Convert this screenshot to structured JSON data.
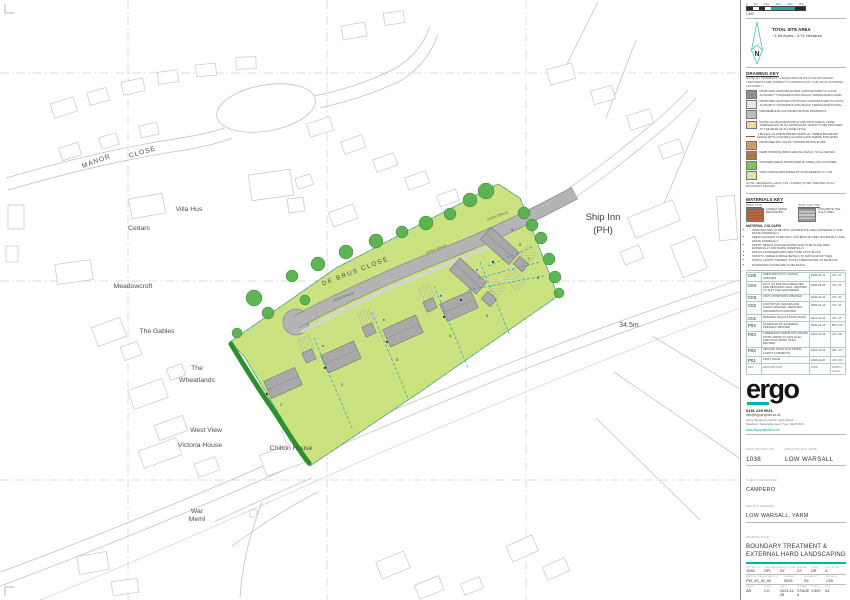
{
  "scale": {
    "ratio_label": "1:500",
    "ticks": [
      "0",
      "5m",
      "10m",
      "15m",
      "20m",
      "25m"
    ]
  },
  "north": {
    "label": "N"
  },
  "site_area": {
    "title": "TOTAL SITE AREA",
    "value": "~1.84 Acres - 0.74 Hectares"
  },
  "drawing_key": {
    "heading": "DRAWING KEY",
    "note": "NOTE: ALL MATERIALS / LANDSCAPE DETAILS AND BOUNDARY TREATMENTS ARE SUBJECT TO APPROVAL BY THE LOCAL PLANNING AUTHORITY",
    "items": [
      {
        "label": "PROPOSED ADOPTED ROADS CONSTRUCTED TO LOCAL AUTHORITY STANDARDS WITH BLACK TARMACADAM FINISH"
      },
      {
        "label": "PROPOSED ADOPTED FOOTPATHS CONSTRUCTED TO LOCAL AUTHORITY STANDARDS WITH BLACK TARMACADAM FINISH"
      },
      {
        "label": "PERMEABLE BLOCK PAVED PRIVATE DRIVEWAYS"
      },
      {
        "label": "PAVING SLAB ACCESS PATHS AND PATIO AREAS. LEVEL THRESHOLDS TO ALL ENTRANCES. PATIOS TO BE PROVIDED TO THE REAR OF ALL DWELLINGS"
      },
      {
        "label": "1.8M HIGH CLOSE BOARDED VERTICAL TIMBER BOUNDARY FENCE WITH LOCKABLE ACCESS GATE WHERE INDICATED"
      },
      {
        "label": "PROPOSED BIG GALAXY 600x600 PAVING SLABS"
      },
      {
        "label": "KERB STANDING BRICK EDGING DETAIL TO ALL DRIVES"
      },
      {
        "label": "GRASSED AREAS MAINTAINED BY DWELLING OCCUPIER"
      },
      {
        "label": "OPEN SPACE MAINTAINED BY MANAGEMENT CO. LTD"
      }
    ],
    "footnote": "NOTE: HEDGEHOG GAPS (130 x 130MM) TO BE CREATED IN ALL BOUNDARY FENCES"
  },
  "materials": {
    "heading": "MATERIALS KEY",
    "brick": {
      "title": "BRICK TYPE",
      "label": "FORMAT MIXED BRICKWORK"
    },
    "roof": {
      "title": "ROOF TILE TYPE",
      "label": "CONCRETE TILE LIGHT GREY"
    },
    "colours_heading": "MATERIAL COLOURS",
    "colours": [
      "WINDOWS ARE TO BE UPVC ANTHRACITE GREY EXTERNALLY AND WHITE INTERNALLY",
      "FRENCH DOORS TO BE UPVC ANTHRACITE GREY EXTERNALLY AND WHITE INTERNALLY",
      "FRONT, REAR & GARAGE DOORS ARE TO BE SLATE GREY EXTERNALLY AND WHITE INTERNALLY",
      "FASCIA & BARGEBOARDS ARE TO BE UPVC BLACK",
      "SOFFITS, VERGE & RIDGE DETAILS TO MATCH ROOF TILES",
      "PORCH CANOPY FRAMES, POSTS & BRICKWORK TO BE BLACK",
      "RAINWATER GOODS ARE TO BE BLACK"
    ]
  },
  "revisions": {
    "headers": {
      "rev": "REV",
      "desc": "DESCRIPTION",
      "date": "DATE",
      "by": "DRWN / CHKD"
    },
    "rows": [
      {
        "rev": "C05",
        "desc": "SHED AND PLOT 1 FENCE UPDATED",
        "date": "2025-02-12",
        "by": "CO / JT"
      },
      {
        "rev": "C04",
        "desc": "PLOT 2/3 RAILINGS REMOVED AND RETAINING WALL UPDATED TO SUIT CIVIL ENGINEERS",
        "date": "2025-02-06",
        "by": "CO / JT"
      },
      {
        "rev": "C03",
        "desc": "UNIT 1 POSITIONS UPDATED",
        "date": "2025-01-31",
        "by": "CO / JT"
      },
      {
        "rev": "C02",
        "desc": "FOOTPATHS, FENCES AND GATES UPDATED, SERVICES INFORMATION UPDATED",
        "date": "2025-01-10",
        "by": "CO / JT"
      },
      {
        "rev": "C01",
        "desc": "BUILDING REGULATIONS ISSUE",
        "date": "2024-12-20",
        "by": "CO / JT"
      },
      {
        "rev": "P04",
        "desc": "SCHEDULE OF EXTERNAL FINISHES UPDATED",
        "date": "2024-12-13",
        "by": "MG / CF"
      },
      {
        "rev": "P03",
        "desc": "THRESHOLD AND BLOCK PAVING POINT ADDED TO SITE PLAN AND ROOF WORK TILES REVISED",
        "date": "2024-12-09",
        "by": "CO / AD"
      },
      {
        "rev": "P02",
        "desc": "SECOND ISSUE FOLLOWING CLIENT COMMENTS",
        "date": "2024-12-02",
        "by": "AN / CO"
      },
      {
        "rev": "P01",
        "desc": "FIRST ISSUE",
        "date": "2024-11-26",
        "by": "AN / CO"
      }
    ]
  },
  "firm": {
    "logo": "ergo",
    "phone": "0191 229 9021",
    "email": "info@ergoprojects.co.uk",
    "address1": "Azure Business Centre, High Street,",
    "address2": "Newburn, Newcastle upon Tyne, NE15 8LN",
    "website": "www.ergoprojects.co.uk"
  },
  "project": {
    "no_label": "ERGO PROJECT No.",
    "no": "1038",
    "name_label": "ERGO PROJECT NAME",
    "name": "LOW WARSALL",
    "client_label": "CLIENT / DEVELOPER",
    "client": "CAMPERO",
    "address_label": "PROJECT ADDRESS",
    "address": "LOW WARSALL, YARM"
  },
  "drawing": {
    "title_label": "DRAWING TITLE",
    "title1": "BOUNDARY TREATMENT &",
    "title2": "EXTERNAL HARD LANDSCAPING"
  },
  "codes": {
    "row1_labels": [
      "PROJECT ID",
      "ORIGINATOR",
      "FUNCTIONAL",
      "SPATIAL",
      "FORM",
      "DISCIPLINE"
    ],
    "row1_values": [
      "1038",
      "GFL",
      "ZZ",
      "ZZ",
      "DR",
      "A"
    ],
    "row2_labels": [
      "UNIQUE CLASSIFICATION",
      "NUMBER",
      "SUITABILITY",
      "REVISION"
    ],
    "row2_values": [
      "PW_40_40_00",
      "0003",
      "S4",
      "C05"
    ],
    "row3_labels": [
      "DRWN",
      "CHKD",
      "DATE",
      "FORMAT",
      "SCALE",
      "SIZE"
    ],
    "row3_values": [
      "AN",
      "CO",
      "2024-11-25",
      "STAGE 4",
      "1:500",
      "A1"
    ]
  },
  "note": "NOTE: This information is © Ergo Projects Limited. Drawing measurements shall not be obtained by scaling. Verify all dimensions prior to manufacture or construction. Immediately report any discrepancies to Ergo Projects Limited. This information shall be read in conjunction with all associated drawings, specifications, and all other related project information.",
  "map": {
    "labels": {
      "manor": "MANOR",
      "close": "CLOSE",
      "villa_hus": "Villa Hus",
      "cedars": "Cedars",
      "meadowcroft": "Meadowcroft",
      "gables": "The Gables",
      "the": "The",
      "wheatlands": "Wheatlands",
      "west_view": "West View",
      "victoria": "Victoria House",
      "chilton": "Chilton House",
      "war": "War",
      "meml": "Meml",
      "ship_inn": "Ship Inn",
      "ph": "(PH)",
      "spot_height": "34.5m",
      "de_brus": "DE BRUS CLOSE",
      "open_space": "OPEN SPACE"
    },
    "plots": [
      "1",
      "2",
      "3",
      "4",
      "5",
      "6",
      "7",
      "8",
      "9"
    ]
  }
}
